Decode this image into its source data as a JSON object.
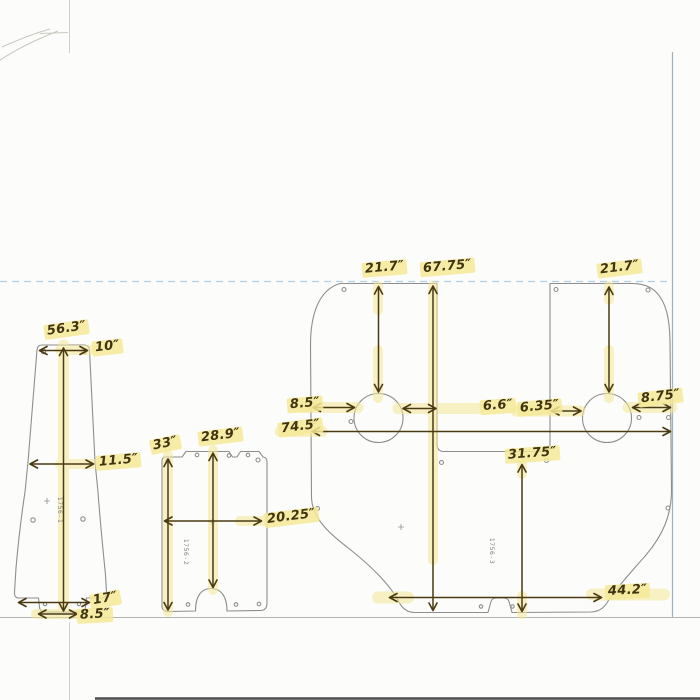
{
  "drawing": {
    "parts": {
      "p1": {
        "id": "1756-1",
        "dims": {
          "height": "56.3″",
          "top_width": "10″",
          "mid_width": "11.5″",
          "bottom_width": "17″",
          "tab_width": "8.5″"
        }
      },
      "p2": {
        "id": "1756-2",
        "dims": {
          "height": "33″",
          "front_height": "28.9″",
          "width": "20.25″"
        }
      },
      "p3": {
        "id": "1756-3",
        "dims": {
          "left_height": "21.7″",
          "overall_height": "67.75″",
          "right_height": "21.7″",
          "left_inset": "8.5″",
          "left_gap": "6.6″",
          "right_gap": "6.35″",
          "right_inset": "8.75″",
          "overall_width": "74.5″",
          "lower_height": "31.75″",
          "bottom_width": "44.2″"
        }
      }
    },
    "colors": {
      "ink": "#4a3a12",
      "highlighter": "#f4e897",
      "outline": "#8e8e8e",
      "guide_blue": "#aac9df"
    }
  }
}
